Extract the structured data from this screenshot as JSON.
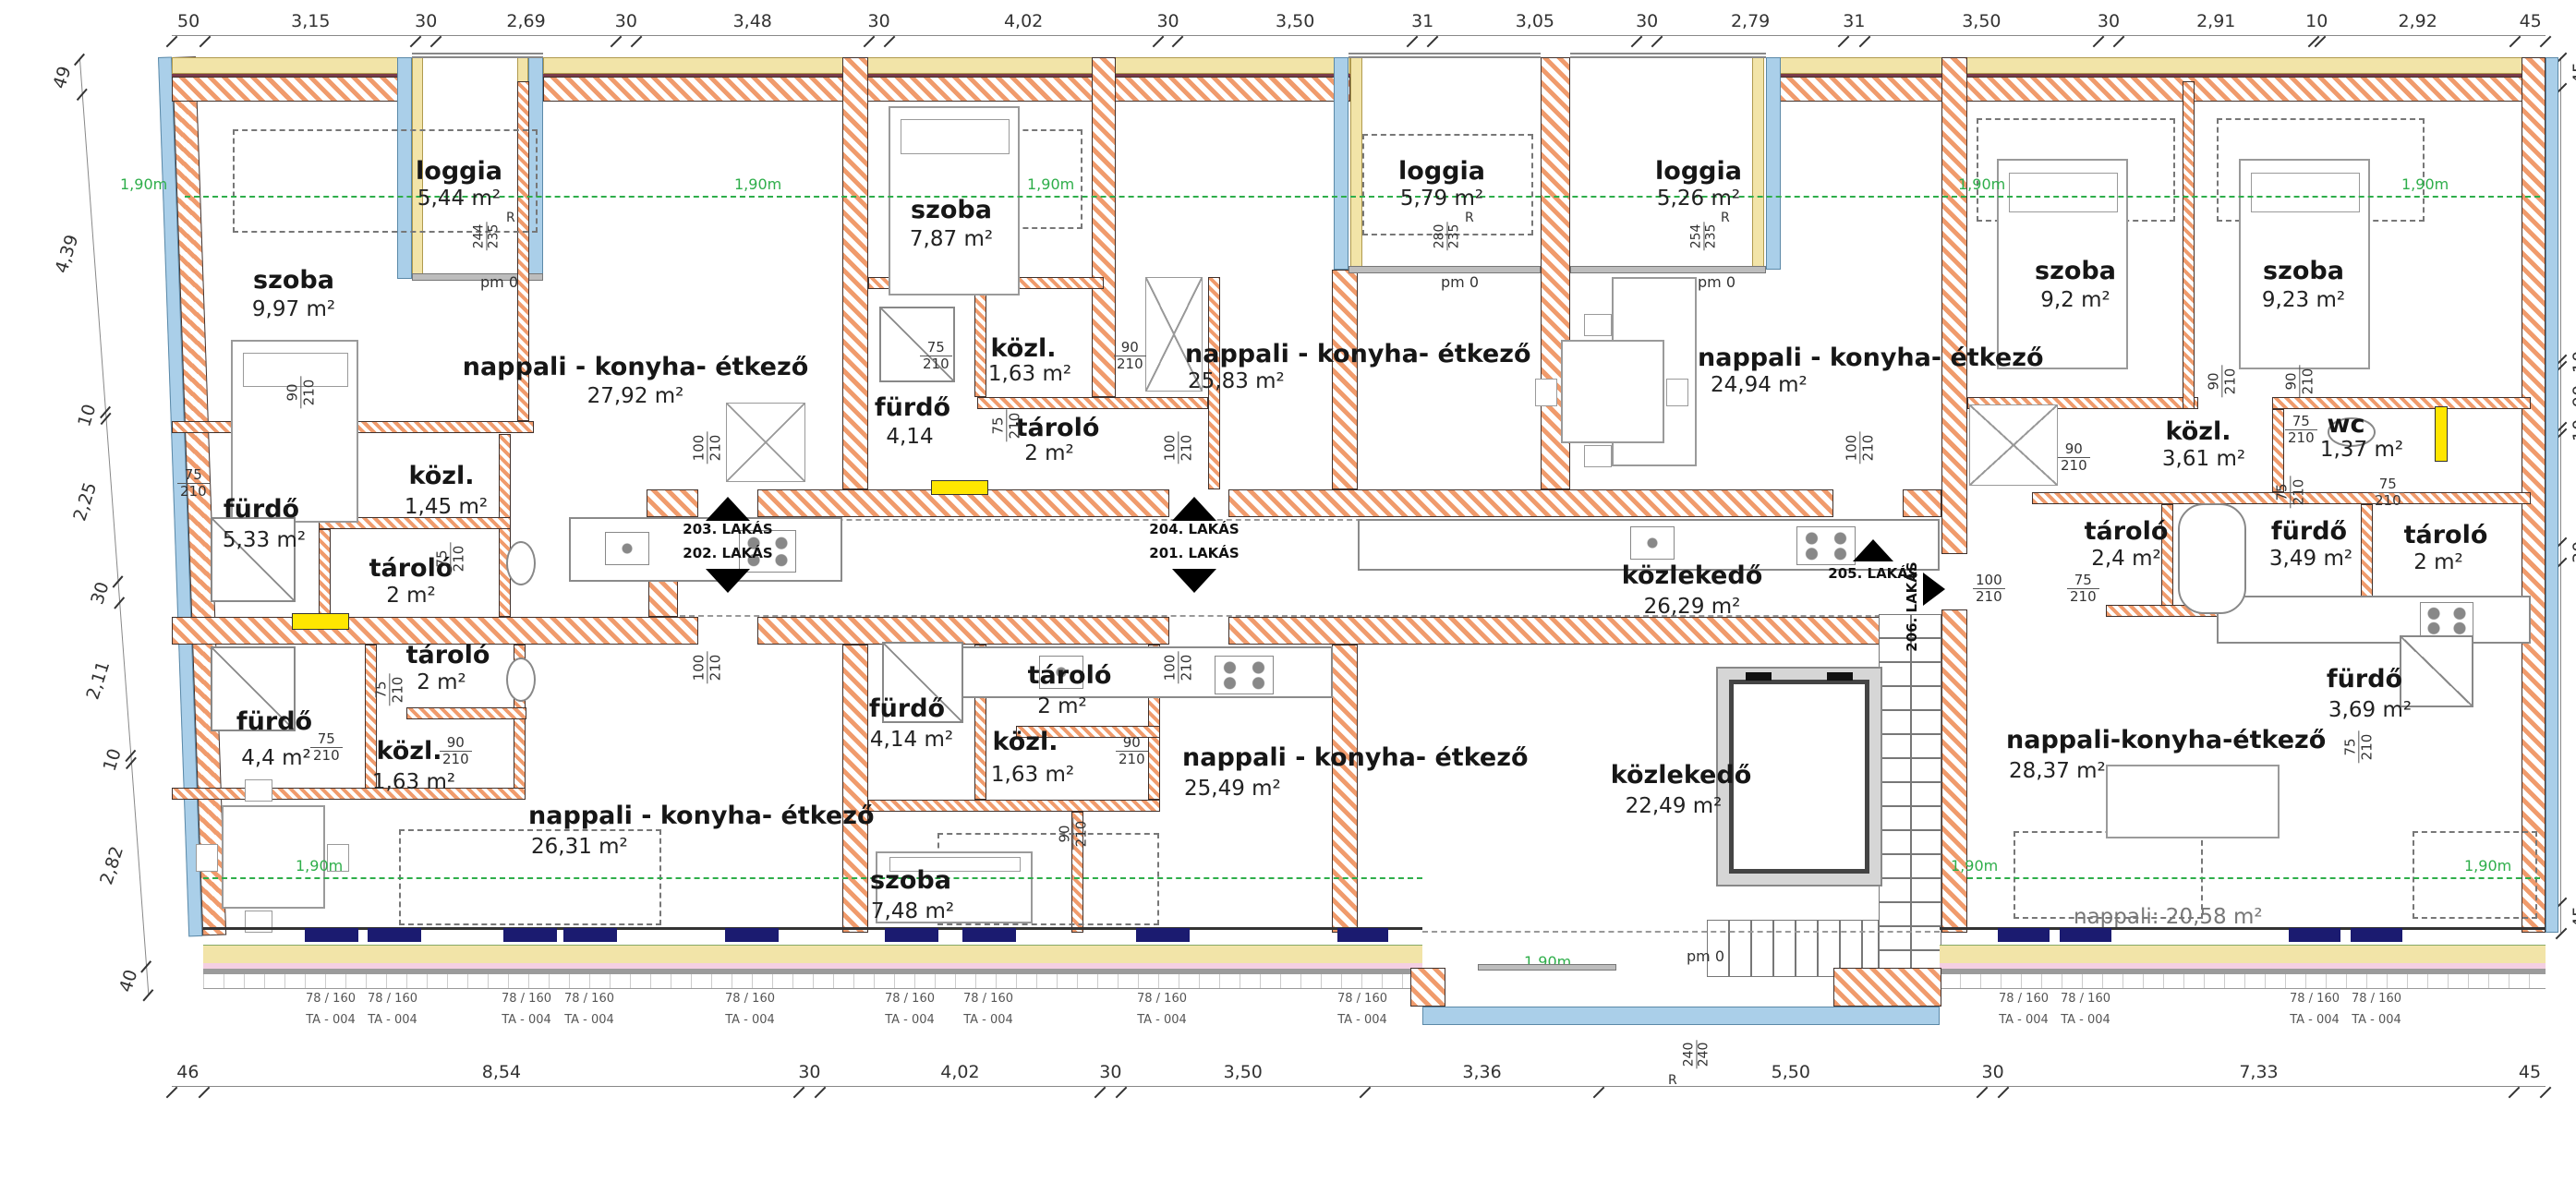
{
  "dims": {
    "top_labels": [
      "50",
      "3,15",
      "30",
      "2,69",
      "30",
      "3,48",
      "30",
      "4,02",
      "30",
      "3,50",
      "31",
      "3,05",
      "30",
      "2,79",
      "31",
      "3,50",
      "30",
      "2,91",
      "10",
      "2,92",
      "45"
    ],
    "top_w": [
      0.5,
      3.15,
      0.3,
      2.69,
      0.3,
      3.48,
      0.3,
      4.02,
      0.3,
      3.5,
      0.31,
      3.05,
      0.3,
      2.79,
      0.31,
      3.5,
      0.3,
      2.91,
      0.1,
      2.92,
      0.45
    ],
    "bottom_labels": [
      "46",
      "8,54",
      "30",
      "4,02",
      "30",
      "3,50",
      "3,36",
      "5,50",
      "30",
      "7,33",
      "45"
    ],
    "bottom_w": [
      0.46,
      8.54,
      0.3,
      4.02,
      0.3,
      3.5,
      3.36,
      5.5,
      0.3,
      7.33,
      0.45
    ],
    "left_labels": [
      "49",
      "4,39",
      "10",
      "2,25",
      "30",
      "2,11",
      "10",
      "2,82",
      "40"
    ],
    "left_w": [
      0.49,
      4.39,
      0.1,
      2.25,
      0.3,
      2.11,
      0.1,
      2.82,
      0.4
    ],
    "right_labels": [
      "45",
      "3,99",
      "10",
      "90",
      "10",
      "1,60",
      "30",
      "5,00",
      "45"
    ],
    "right_w": [
      0.45,
      3.99,
      0.1,
      0.9,
      0.1,
      1.6,
      0.3,
      5.0,
      0.45
    ]
  },
  "rooms": {
    "szoba1": {
      "name": "szoba",
      "area": "9,97 m²"
    },
    "loggia1": {
      "name": "loggia",
      "area": "5,44 m²"
    },
    "nappali1": {
      "name": "nappali - konyha- étkező",
      "area": "27,92 m²"
    },
    "furdo1": {
      "name": "fürdő",
      "area": "5,33 m²"
    },
    "kozl1": {
      "name": "közl.",
      "area": "1,45 m²"
    },
    "tarolo1": {
      "name": "tároló",
      "area": "2 m²"
    },
    "szoba2": {
      "name": "szoba",
      "area": "7,87 m²"
    },
    "furdo3": {
      "name": "fürdő",
      "area": "4,14"
    },
    "kozl2": {
      "name": "közl.",
      "area": "1,63 m²"
    },
    "tarolo2": {
      "name": "tároló",
      "area": "2 m²"
    },
    "nappali2": {
      "name": "nappali - konyha- étkező",
      "area": "25,83 m²"
    },
    "loggia2": {
      "name": "loggia",
      "area": "5,79 m²"
    },
    "loggia3": {
      "name": "loggia",
      "area": "5,26 m²"
    },
    "nappali3": {
      "name": "nappali - konyha- étkező",
      "area": "24,94 m²"
    },
    "szoba3": {
      "name": "szoba",
      "area": "9,2 m²"
    },
    "szoba4": {
      "name": "szoba",
      "area": "9,23 m²"
    },
    "kozl3": {
      "name": "közl.",
      "area": "3,61 m²"
    },
    "wc": {
      "name": "wc",
      "area": "1,37 m²"
    },
    "tarolo3": {
      "name": "tároló",
      "area": "2,4 m²"
    },
    "furdo4": {
      "name": "fürdő",
      "area": "3,49 m²"
    },
    "tarolo4": {
      "name": "tároló",
      "area": "2 m²"
    },
    "kozlekedo1": {
      "name": "közlekedő",
      "area": "26,29 m²"
    },
    "furdo2": {
      "name": "fürdő",
      "area": "4,4 m²"
    },
    "tarolo5": {
      "name": "tároló",
      "area": "2 m²"
    },
    "kozl4": {
      "name": "közl.",
      "area": "1,63 m²"
    },
    "nappali4": {
      "name": "nappali - konyha- étkező",
      "area": "26,31 m²"
    },
    "furdo5": {
      "name": "fürdő",
      "area": "4,14 m²"
    },
    "kozl5": {
      "name": "közl.",
      "area": "1,63 m²"
    },
    "tarolo6": {
      "name": "tároló",
      "area": "2 m²"
    },
    "szoba5": {
      "name": "szoba",
      "area": "7,48 m²"
    },
    "nappali5": {
      "name": "nappali - konyha- étkező",
      "area": "25,49 m²"
    },
    "kozlekedo2": {
      "name": "közlekedő",
      "area": "22,49 m²"
    },
    "nappali6": {
      "name": "nappali-konyha-étkező",
      "area": "28,37 m²"
    },
    "furdo6": {
      "name": "fürdő",
      "area": "3,69 m²"
    },
    "nappali_sub": {
      "label": "nappali: 20,58 m²"
    }
  },
  "markers": {
    "a203": "203. LAKÁS",
    "a202": "202. LAKÁS",
    "a204": "204. LAKÁS",
    "a201": "201. LAKÁS",
    "a205": "205. LAKÁS",
    "a206": "206. LAKÁS"
  },
  "doors": {
    "d75": "75",
    "d90": "90",
    "d100": "100",
    "h210": "210"
  },
  "loggia_info": {
    "r": "R",
    "pm": "pm 0",
    "l1a": "244",
    "l1b": "235",
    "l2a": "280",
    "l2b": "235",
    "l3a": "254",
    "l3b": "235"
  },
  "entrance": {
    "pm": "pm 0",
    "r": "R",
    "a": "240",
    "b": "240"
  },
  "green_label": "1,90m",
  "windows": {
    "size": "78 / 160",
    "type": "TA - 004"
  }
}
